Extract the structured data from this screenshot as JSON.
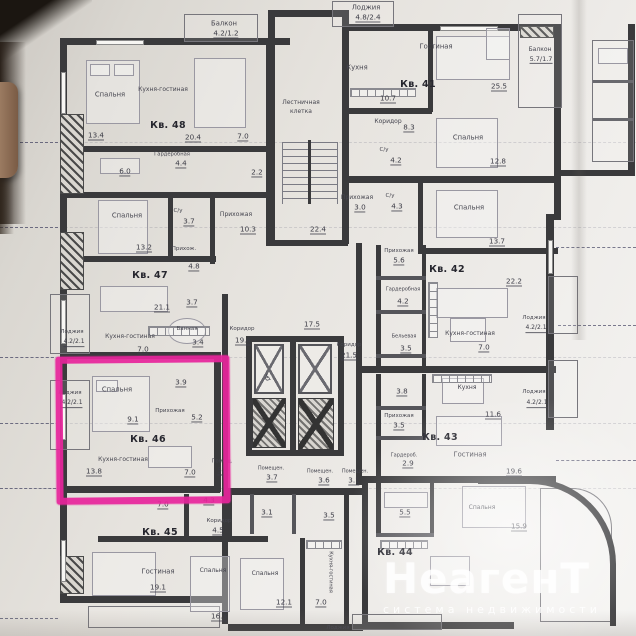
{
  "photo": {
    "watermark": {
      "title": "НеагенТ",
      "subtitle": "система недвижимости"
    },
    "highlight": {
      "apartment": "Кв. 46",
      "color": "#e8259c"
    }
  },
  "plan": {
    "apartments": [
      "Кв. 41",
      "Кв. 42",
      "Кв. 43",
      "Кв. 44",
      "Кв. 45",
      "Кв. 46",
      "Кв. 47",
      "Кв. 48"
    ],
    "labels": [
      {
        "text": "Балкон",
        "x": 224,
        "y": 24
      },
      {
        "text": "4.2/1.2",
        "x": 226,
        "y": 34,
        "area": true
      },
      {
        "text": "Лоджия",
        "x": 366,
        "y": 8
      },
      {
        "text": "4.8/2.4",
        "x": 368,
        "y": 18,
        "area": true
      },
      {
        "text": "Кухня",
        "x": 357,
        "y": 68
      },
      {
        "text": "10.7",
        "x": 388,
        "y": 99,
        "area": true
      },
      {
        "text": "Кв. 41",
        "x": 418,
        "y": 85,
        "bold": true,
        "name": "apartment-41-label"
      },
      {
        "text": "Гостиная",
        "x": 436,
        "y": 47
      },
      {
        "text": "25.5",
        "x": 499,
        "y": 87,
        "area": true
      },
      {
        "text": "Балкон",
        "x": 540,
        "y": 50,
        "size": 6
      },
      {
        "text": "5.7/1.7",
        "x": 541,
        "y": 60,
        "area": true,
        "size": 6.5
      },
      {
        "text": "Спальня",
        "x": 468,
        "y": 138
      },
      {
        "text": "12.8",
        "x": 498,
        "y": 162,
        "area": true
      },
      {
        "text": "Коридор",
        "x": 388,
        "y": 122,
        "size": 6
      },
      {
        "text": "8.3",
        "x": 409,
        "y": 128,
        "area": true
      },
      {
        "text": "С/у",
        "x": 384,
        "y": 151,
        "size": 5.5
      },
      {
        "text": "4.2",
        "x": 396,
        "y": 161,
        "area": true
      },
      {
        "text": "Прихожая",
        "x": 357,
        "y": 198,
        "size": 6
      },
      {
        "text": "3.0",
        "x": 360,
        "y": 208,
        "area": true
      },
      {
        "text": "Лестничная",
        "x": 301,
        "y": 103,
        "size": 6
      },
      {
        "text": "клетка",
        "x": 301,
        "y": 112,
        "size": 6
      },
      {
        "text": "22.4",
        "x": 318,
        "y": 230,
        "area": true
      },
      {
        "text": "Спальня",
        "x": 110,
        "y": 95
      },
      {
        "text": "13.4",
        "x": 96,
        "y": 136,
        "area": true
      },
      {
        "text": "Кухня-гостиная",
        "x": 163,
        "y": 90,
        "size": 6
      },
      {
        "text": "Кв. 48",
        "x": 168,
        "y": 126,
        "bold": true,
        "name": "apartment-48-label"
      },
      {
        "text": "20.4",
        "x": 193,
        "y": 138,
        "area": true
      },
      {
        "text": "7.0",
        "x": 243,
        "y": 137,
        "area": true
      },
      {
        "text": "Гардеробная",
        "x": 172,
        "y": 155,
        "size": 5.2
      },
      {
        "text": "4.4",
        "x": 181,
        "y": 164,
        "area": true
      },
      {
        "text": "6.0",
        "x": 125,
        "y": 172,
        "area": true
      },
      {
        "text": "2.2",
        "x": 257,
        "y": 173,
        "area": true
      },
      {
        "text": "С/у",
        "x": 178,
        "y": 212,
        "size": 5.5
      },
      {
        "text": "3.7",
        "x": 189,
        "y": 222,
        "area": true
      },
      {
        "text": "Прихожая",
        "x": 236,
        "y": 215,
        "size": 6
      },
      {
        "text": "10.3",
        "x": 248,
        "y": 230,
        "area": true
      },
      {
        "text": "Спальня",
        "x": 127,
        "y": 216
      },
      {
        "text": "13.2",
        "x": 144,
        "y": 248,
        "area": true
      },
      {
        "text": "Прихож.",
        "x": 184,
        "y": 250,
        "size": 5.5
      },
      {
        "text": "4.8",
        "x": 194,
        "y": 267,
        "area": true
      },
      {
        "text": "Кв. 47",
        "x": 150,
        "y": 276,
        "bold": true,
        "name": "apartment-47-label"
      },
      {
        "text": "Кухня-гостиная",
        "x": 130,
        "y": 337,
        "size": 6
      },
      {
        "text": "21.1",
        "x": 162,
        "y": 308,
        "area": true
      },
      {
        "text": "3.7",
        "x": 192,
        "y": 303,
        "area": true
      },
      {
        "text": "Ванная",
        "x": 187,
        "y": 330,
        "size": 5.5
      },
      {
        "text": "3.4",
        "x": 198,
        "y": 343,
        "area": true
      },
      {
        "text": "7.0",
        "x": 143,
        "y": 350,
        "area": true
      },
      {
        "text": "Лоджия",
        "x": 72,
        "y": 333,
        "size": 5.5
      },
      {
        "text": "4.2/2.1",
        "x": 74,
        "y": 343,
        "area": true,
        "size": 6
      },
      {
        "text": "Коридор",
        "x": 242,
        "y": 330,
        "size": 5.5
      },
      {
        "text": "19.8",
        "x": 243,
        "y": 341,
        "area": true
      },
      {
        "text": "17.5",
        "x": 312,
        "y": 325,
        "area": true
      },
      {
        "text": "Коридор",
        "x": 349,
        "y": 346,
        "size": 5.5
      },
      {
        "text": "21.5",
        "x": 349,
        "y": 356,
        "area": true
      },
      {
        "text": "Лоджия",
        "x": 70,
        "y": 394,
        "size": 5.5
      },
      {
        "text": "4.2/2.1",
        "x": 72,
        "y": 404,
        "area": true,
        "size": 6
      },
      {
        "text": "Спальня",
        "x": 117,
        "y": 390
      },
      {
        "text": "9.1",
        "x": 133,
        "y": 420,
        "area": true
      },
      {
        "text": "3.9",
        "x": 181,
        "y": 383,
        "area": true
      },
      {
        "text": "Прихожая",
        "x": 170,
        "y": 412,
        "size": 5.5
      },
      {
        "text": "5.2",
        "x": 197,
        "y": 418,
        "area": true
      },
      {
        "text": "Кв. 46",
        "x": 148,
        "y": 440,
        "bold": true,
        "name": "apartment-46-label"
      },
      {
        "text": "Кухня-гостиная",
        "x": 123,
        "y": 460,
        "size": 6
      },
      {
        "text": "13.8",
        "x": 94,
        "y": 472,
        "area": true
      },
      {
        "text": "7.0",
        "x": 190,
        "y": 473,
        "area": true
      },
      {
        "text": "Помещ.",
        "x": 222,
        "y": 462,
        "size": 5.2
      },
      {
        "text": "5.9",
        "x": 223,
        "y": 471,
        "area": true
      },
      {
        "text": "Спальня",
        "x": 469,
        "y": 208
      },
      {
        "text": "13.7",
        "x": 497,
        "y": 242,
        "area": true
      },
      {
        "text": "С/у",
        "x": 390,
        "y": 197,
        "size": 5.5
      },
      {
        "text": "4.3",
        "x": 397,
        "y": 207,
        "area": true
      },
      {
        "text": "Кв. 42",
        "x": 447,
        "y": 270,
        "bold": true,
        "name": "apartment-42-label"
      },
      {
        "text": "Прихожая",
        "x": 399,
        "y": 252,
        "size": 5.5
      },
      {
        "text": "5.6",
        "x": 399,
        "y": 261,
        "area": true
      },
      {
        "text": "Гардеробная",
        "x": 403,
        "y": 290,
        "size": 5
      },
      {
        "text": "4.2",
        "x": 403,
        "y": 302,
        "area": true
      },
      {
        "text": "Бельевая",
        "x": 404,
        "y": 337,
        "size": 5
      },
      {
        "text": "3.5",
        "x": 406,
        "y": 349,
        "area": true
      },
      {
        "text": "Кухня-гостиная",
        "x": 470,
        "y": 334,
        "size": 6
      },
      {
        "text": "22.2",
        "x": 514,
        "y": 282,
        "area": true
      },
      {
        "text": "7.0",
        "x": 484,
        "y": 348,
        "area": true
      },
      {
        "text": "Лоджия",
        "x": 534,
        "y": 319,
        "size": 5.5
      },
      {
        "text": "4.2/2.1",
        "x": 536,
        "y": 329,
        "area": true,
        "size": 6
      },
      {
        "text": "3.8",
        "x": 402,
        "y": 392,
        "area": true
      },
      {
        "text": "Прихожая",
        "x": 399,
        "y": 417,
        "size": 5.5
      },
      {
        "text": "3.5",
        "x": 399,
        "y": 426,
        "area": true
      },
      {
        "text": "Кухня",
        "x": 467,
        "y": 388,
        "size": 6
      },
      {
        "text": "11.6",
        "x": 493,
        "y": 415,
        "area": true
      },
      {
        "text": "Кв. 43",
        "x": 440,
        "y": 438,
        "bold": true,
        "name": "apartment-43-label"
      },
      {
        "text": "Гостиная",
        "x": 470,
        "y": 455
      },
      {
        "text": "19.6",
        "x": 514,
        "y": 472,
        "area": true
      },
      {
        "text": "Гардероб.",
        "x": 404,
        "y": 456,
        "size": 5
      },
      {
        "text": "2.9",
        "x": 408,
        "y": 464,
        "area": true
      },
      {
        "text": "Лоджия",
        "x": 534,
        "y": 393,
        "size": 5.5
      },
      {
        "text": "4.2/2.1",
        "x": 537,
        "y": 404,
        "area": true,
        "size": 6
      },
      {
        "text": "Помещен.",
        "x": 271,
        "y": 469,
        "size": 5
      },
      {
        "text": "3.7",
        "x": 272,
        "y": 478,
        "area": true
      },
      {
        "text": "Помещен.",
        "x": 320,
        "y": 472,
        "size": 5
      },
      {
        "text": "3.6",
        "x": 324,
        "y": 481,
        "area": true
      },
      {
        "text": "Помещен.",
        "x": 355,
        "y": 472,
        "size": 5
      },
      {
        "text": "3.1",
        "x": 354,
        "y": 481,
        "area": true
      },
      {
        "text": "7.0",
        "x": 163,
        "y": 505,
        "area": true
      },
      {
        "text": "4.3",
        "x": 209,
        "y": 501,
        "area": true
      },
      {
        "text": "Коридор",
        "x": 219,
        "y": 522,
        "size": 5.5
      },
      {
        "text": "4.5",
        "x": 218,
        "y": 531,
        "area": true
      },
      {
        "text": "Кв. 45",
        "x": 160,
        "y": 533,
        "bold": true,
        "name": "apartment-45-label"
      },
      {
        "text": "Гостиная",
        "x": 158,
        "y": 572
      },
      {
        "text": "19.1",
        "x": 158,
        "y": 588,
        "area": true
      },
      {
        "text": "3.1",
        "x": 267,
        "y": 513,
        "area": true
      },
      {
        "text": "3.5",
        "x": 329,
        "y": 516,
        "area": true
      },
      {
        "text": "Спальня",
        "x": 213,
        "y": 571,
        "size": 6
      },
      {
        "text": "16.3",
        "x": 219,
        "y": 617,
        "area": true
      },
      {
        "text": "Спальня",
        "x": 265,
        "y": 574,
        "size": 6
      },
      {
        "text": "12.1",
        "x": 284,
        "y": 603,
        "area": true
      },
      {
        "text": "Кухня-гостиная",
        "x": 330,
        "y": 572,
        "size": 5,
        "rot": 90
      },
      {
        "text": "7.0",
        "x": 321,
        "y": 603,
        "area": true
      },
      {
        "text": "5.5",
        "x": 405,
        "y": 513,
        "area": true
      },
      {
        "text": "Кв. 44",
        "x": 395,
        "y": 553,
        "bold": true,
        "name": "apartment-44-label"
      },
      {
        "text": "Спальня",
        "x": 482,
        "y": 508,
        "size": 6
      },
      {
        "text": "15.9",
        "x": 519,
        "y": 527,
        "area": true
      },
      {
        "text": "Лоджия",
        "x": 338,
        "y": 629,
        "size": 5.5
      },
      {
        "text": "♿",
        "x": 268,
        "y": 379,
        "size": 9,
        "name": "wheelchair-elevator-icon"
      }
    ]
  }
}
